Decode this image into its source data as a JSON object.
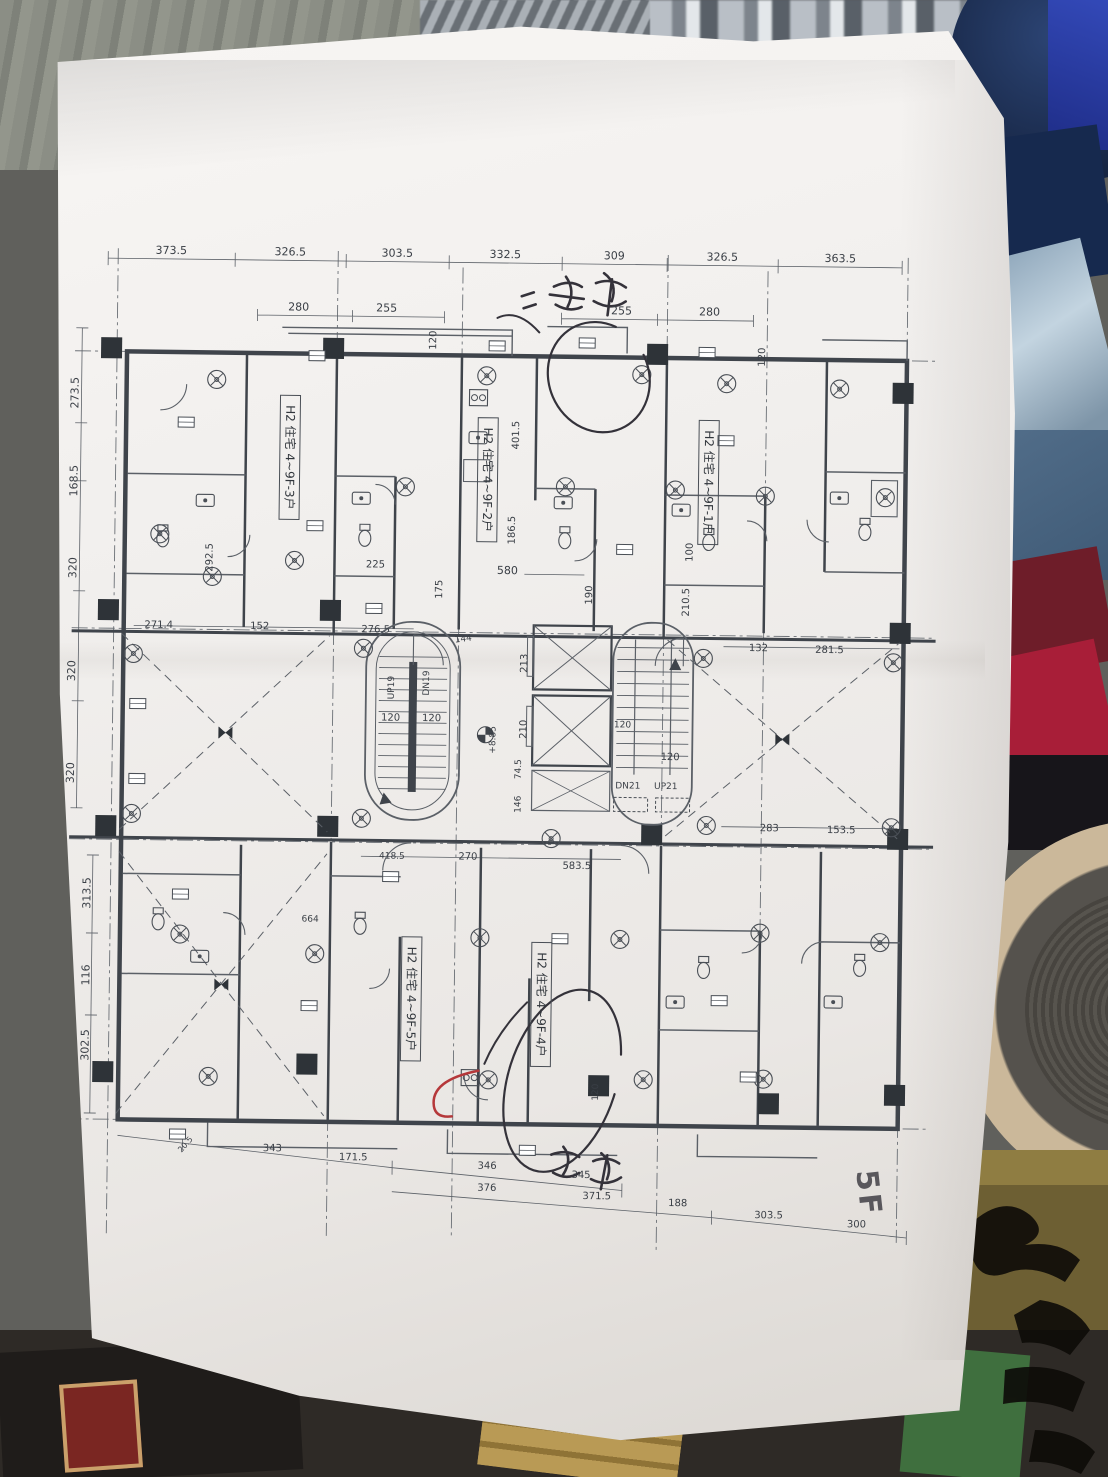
{
  "photo": {
    "floor_label": "5F"
  },
  "plan": {
    "unit_labels": [
      {
        "text": "H2 住宅 4~9F-3户",
        "x": 224,
        "y": 222
      },
      {
        "text": "H2 住宅 4~9F-2户",
        "x": 422,
        "y": 242
      },
      {
        "text": "H2 住宅 4~9F-1户",
        "x": 643,
        "y": 242
      },
      {
        "text": "H2 住宅 4~9F-5户",
        "x": 352,
        "y": 762
      },
      {
        "text": "H2 住宅 4~9F-4户",
        "x": 482,
        "y": 766
      }
    ],
    "texts": [
      {
        "t": "373.5",
        "x": 103,
        "y": 20
      },
      {
        "t": "326.5",
        "x": 222,
        "y": 20
      },
      {
        "t": "303.5",
        "x": 329,
        "y": 20
      },
      {
        "t": "332.5",
        "x": 437,
        "y": 20
      },
      {
        "t": "309",
        "x": 546,
        "y": 20
      },
      {
        "t": "326.5",
        "x": 654,
        "y": 20
      },
      {
        "t": "363.5",
        "x": 772,
        "y": 20
      },
      {
        "t": "280",
        "x": 231,
        "y": 75
      },
      {
        "t": "255",
        "x": 319,
        "y": 75
      },
      {
        "t": "255",
        "x": 554,
        "y": 75
      },
      {
        "t": "280",
        "x": 642,
        "y": 75
      },
      {
        "t": "120",
        "x": 369,
        "y": 103,
        "r": -90,
        "s": 10
      },
      {
        "t": "120",
        "x": 698,
        "y": 116,
        "r": -90,
        "s": 10
      },
      {
        "t": "273.5",
        "x": 12,
        "y": 160,
        "r": -90
      },
      {
        "t": "168.5",
        "x": 12,
        "y": 248,
        "r": -90
      },
      {
        "t": "320",
        "x": 12,
        "y": 335,
        "r": -90
      },
      {
        "t": "320",
        "x": 12,
        "y": 438,
        "r": -90
      },
      {
        "t": "320",
        "x": 12,
        "y": 540,
        "r": -90
      },
      {
        "t": "313.5",
        "x": 30,
        "y": 660,
        "r": -90
      },
      {
        "t": "116",
        "x": 30,
        "y": 742,
        "r": -90
      },
      {
        "t": "302.5",
        "x": 30,
        "y": 812,
        "r": -90
      },
      {
        "t": "401.5",
        "x": 453,
        "y": 197,
        "r": -90,
        "s": 10
      },
      {
        "t": "186.5",
        "x": 450,
        "y": 292,
        "r": -90,
        "s": 10
      },
      {
        "t": "580",
        "x": 443,
        "y": 336
      },
      {
        "t": "175",
        "x": 378,
        "y": 352,
        "r": -90,
        "s": 10
      },
      {
        "t": "190",
        "x": 528,
        "y": 356,
        "r": -90,
        "s": 10
      },
      {
        "t": "100",
        "x": 628,
        "y": 312,
        "r": -90,
        "s": 10
      },
      {
        "t": "210.5",
        "x": 625,
        "y": 362,
        "r": -90,
        "s": 10
      },
      {
        "t": "292.5",
        "x": 148,
        "y": 323,
        "r": -90,
        "s": 10
      },
      {
        "t": "225",
        "x": 311,
        "y": 331,
        "s": 10
      },
      {
        "t": "271.4",
        "x": 95,
        "y": 394,
        "s": 10
      },
      {
        "t": "152",
        "x": 196,
        "y": 394,
        "s": 10
      },
      {
        "t": "276.5",
        "x": 312,
        "y": 396,
        "s": 10
      },
      {
        "t": "213",
        "x": 464,
        "y": 425,
        "r": -90,
        "s": 10
      },
      {
        "t": "210",
        "x": 464,
        "y": 491,
        "r": -90,
        "s": 10
      },
      {
        "t": "74.5",
        "x": 459,
        "y": 531,
        "r": -90,
        "s": 9
      },
      {
        "t": "146",
        "x": 459,
        "y": 566,
        "r": -90,
        "s": 9
      },
      {
        "t": "144",
        "x": 400,
        "y": 404,
        "r": -8,
        "s": 9
      },
      {
        "t": "120",
        "x": 328,
        "y": 484,
        "s": 10
      },
      {
        "t": "120",
        "x": 369,
        "y": 484,
        "s": 10
      },
      {
        "t": "DN19",
        "x": 366,
        "y": 446,
        "r": -90,
        "s": 9
      },
      {
        "t": "UP19",
        "x": 331,
        "y": 451,
        "r": -90,
        "s": 9
      },
      {
        "t": "DN21",
        "x": 566,
        "y": 549,
        "s": 9
      },
      {
        "t": "UP21",
        "x": 604,
        "y": 549,
        "s": 9
      },
      {
        "t": "120",
        "x": 608,
        "y": 520,
        "s": 10
      },
      {
        "t": "120",
        "x": 560,
        "y": 488,
        "s": 9
      },
      {
        "t": "+8.85",
        "x": 433,
        "y": 502,
        "r": -90,
        "s": 9
      },
      {
        "t": "132",
        "x": 695,
        "y": 410,
        "s": 10
      },
      {
        "t": "281.5",
        "x": 766,
        "y": 411,
        "s": 10
      },
      {
        "t": "283",
        "x": 708,
        "y": 590,
        "s": 10
      },
      {
        "t": "153.5",
        "x": 780,
        "y": 591,
        "s": 10
      },
      {
        "t": "418.5",
        "x": 331,
        "y": 622,
        "s": 9
      },
      {
        "t": "270",
        "x": 407,
        "y": 622,
        "s": 10
      },
      {
        "t": "583.5",
        "x": 516,
        "y": 630,
        "s": 10
      },
      {
        "t": "664",
        "x": 250,
        "y": 686,
        "s": 9
      },
      {
        "t": "120",
        "x": 540,
        "y": 853,
        "r": -90,
        "s": 9
      },
      {
        "t": "20.5",
        "x": 130,
        "y": 912,
        "r": -50,
        "s": 8
      },
      {
        "t": "343",
        "x": 215,
        "y": 916,
        "s": 10
      },
      {
        "t": "171.5",
        "x": 296,
        "y": 924,
        "s": 10
      },
      {
        "t": "346",
        "x": 430,
        "y": 931,
        "s": 10
      },
      {
        "t": "345",
        "x": 524,
        "y": 939,
        "s": 10
      },
      {
        "t": "376",
        "x": 430,
        "y": 953,
        "s": 10
      },
      {
        "t": "371.5",
        "x": 540,
        "y": 960,
        "s": 10
      },
      {
        "t": "188",
        "x": 621,
        "y": 966,
        "s": 10
      },
      {
        "t": "303.5",
        "x": 712,
        "y": 977,
        "s": 10
      },
      {
        "t": "300",
        "x": 800,
        "y": 985,
        "s": 10
      },
      {
        "t": "5F",
        "x": 802,
        "y": 952,
        "r": 83,
        "s": 30,
        "c": "hand",
        "n": "floor-label-handwritten"
      }
    ]
  }
}
